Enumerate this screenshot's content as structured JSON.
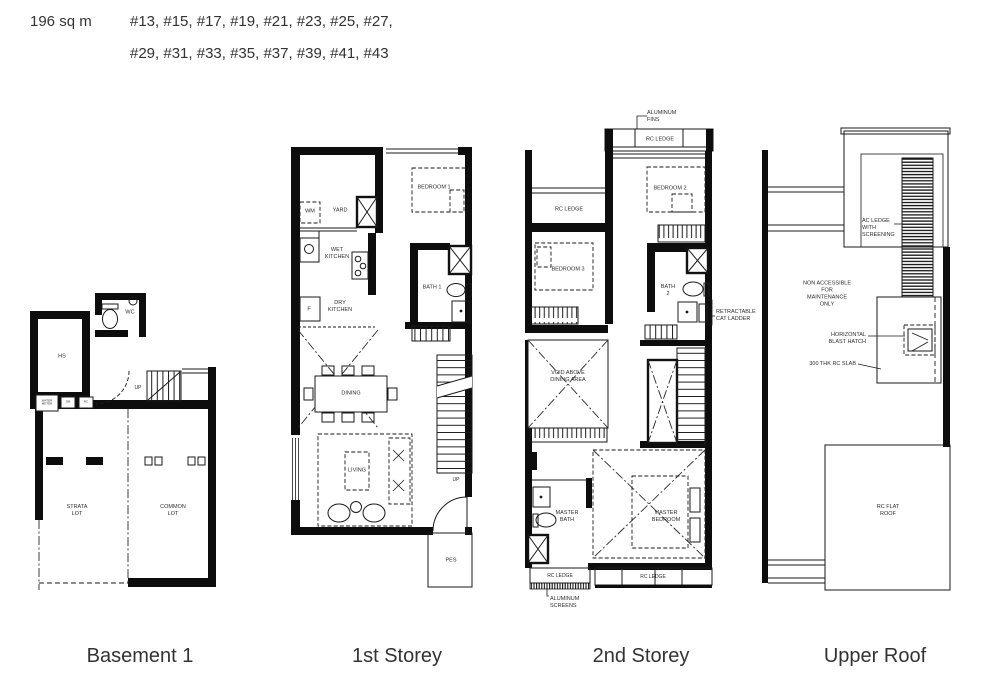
{
  "colors": {
    "wall": "#0d0d0d",
    "line": "#1a1a1a",
    "label": "#2e2e2e",
    "background": "#ffffff"
  },
  "header": {
    "area": "196 sq m",
    "units_line1": "#13, #15, #17, #19, #21, #23, #25, #27,",
    "units_line2": "#29, #31, #33, #35, #37, #39, #41, #43"
  },
  "plans": {
    "basement": {
      "caption": "Basement 1",
      "labels": {
        "wc": "WC",
        "hs": "HS",
        "up": "UP",
        "water_meter": "WATER METER",
        "db": "DB",
        "rc": "RC",
        "strata_lot": "STRATA LOT",
        "common_lot": "COMMON LOT"
      }
    },
    "first_storey": {
      "caption": "1st Storey",
      "labels": {
        "wm": "WM",
        "yard": "YARD",
        "bedroom_1": "BEDROOM 1",
        "wet_kitchen": "WET KITCHEN",
        "fridge": "F",
        "dry_kitchen": "DRY KITCHEN",
        "bath_1": "BATH 1",
        "dining": "DINING",
        "living": "LIVING",
        "up": "UP",
        "pes": "PES"
      }
    },
    "second_storey": {
      "caption": "2nd Storey",
      "labels": {
        "aluminum_fins": "ALUMINUM FINS",
        "rc_ledge_top": "RC LEDGE",
        "bedroom_2": "BEDROOM 2",
        "rc_ledge_left": "RC LEDGE",
        "bedroom_3": "BEDROOM 3",
        "bath_2": "BATH 2",
        "cat_ladder": "RETRACTABLE CAT LADDER",
        "void_above_dining": "VOID ABOVE DINING AREA",
        "master_bath": "MASTER BATH",
        "master_bedroom": "MASTER BEDROOM",
        "rc_ledge_bottom_left": "RC LEDGE",
        "rc_ledge_bottom": "RC LEDGE",
        "aluminum_screens": "ALUMINUM SCREENS"
      }
    },
    "upper_roof": {
      "caption": "Upper Roof",
      "labels": {
        "ac_ledge": "AC LEDGE WITH SCREENING",
        "non_accessible": "NON ACCESSIBLE FOR MAINTENANCE ONLY",
        "blast_hatch": "HORIZONTAL BLAST HATCH",
        "rc_slab": "300 THK RC SLAB",
        "rc_flat_roof": "RC FLAT ROOF"
      }
    }
  }
}
